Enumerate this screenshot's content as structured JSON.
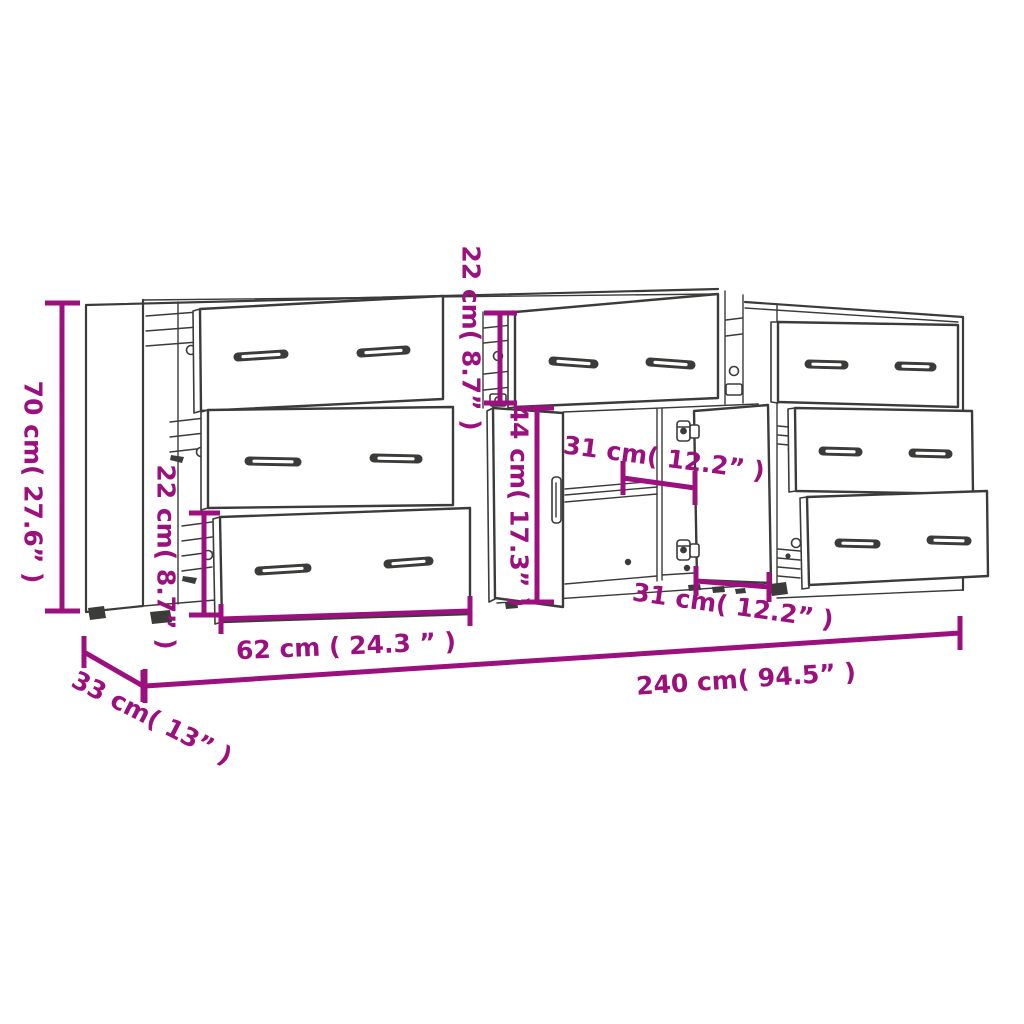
{
  "canvas": {
    "background": "#ffffff"
  },
  "palette": {
    "artwork_line": "#3b3b3a",
    "dimension": "#9b107e"
  },
  "diagram": {
    "description": "Dimension line drawing of three sideboards: left 3-drawer chest with open drawers, middle cabinet with top drawer and two open doors, right 3-drawer chest with open drawers",
    "dimensions": {
      "height_total": "70 cm( 27.6” )",
      "drawer_section_left": "22 cm( 8.7” )",
      "top_section_middle": "22 cm( 8.7” )",
      "door_height": "44 cm( 17.3” )",
      "inner_width_upper": "31 cm( 12.2” )",
      "inner_width_lower": "31 cm( 12.2” )",
      "drawer_front_width": "62 cm ( 24.3 ” )",
      "width_total": "240 cm( 94.5” )",
      "depth": "33 cm( 13” )"
    }
  }
}
